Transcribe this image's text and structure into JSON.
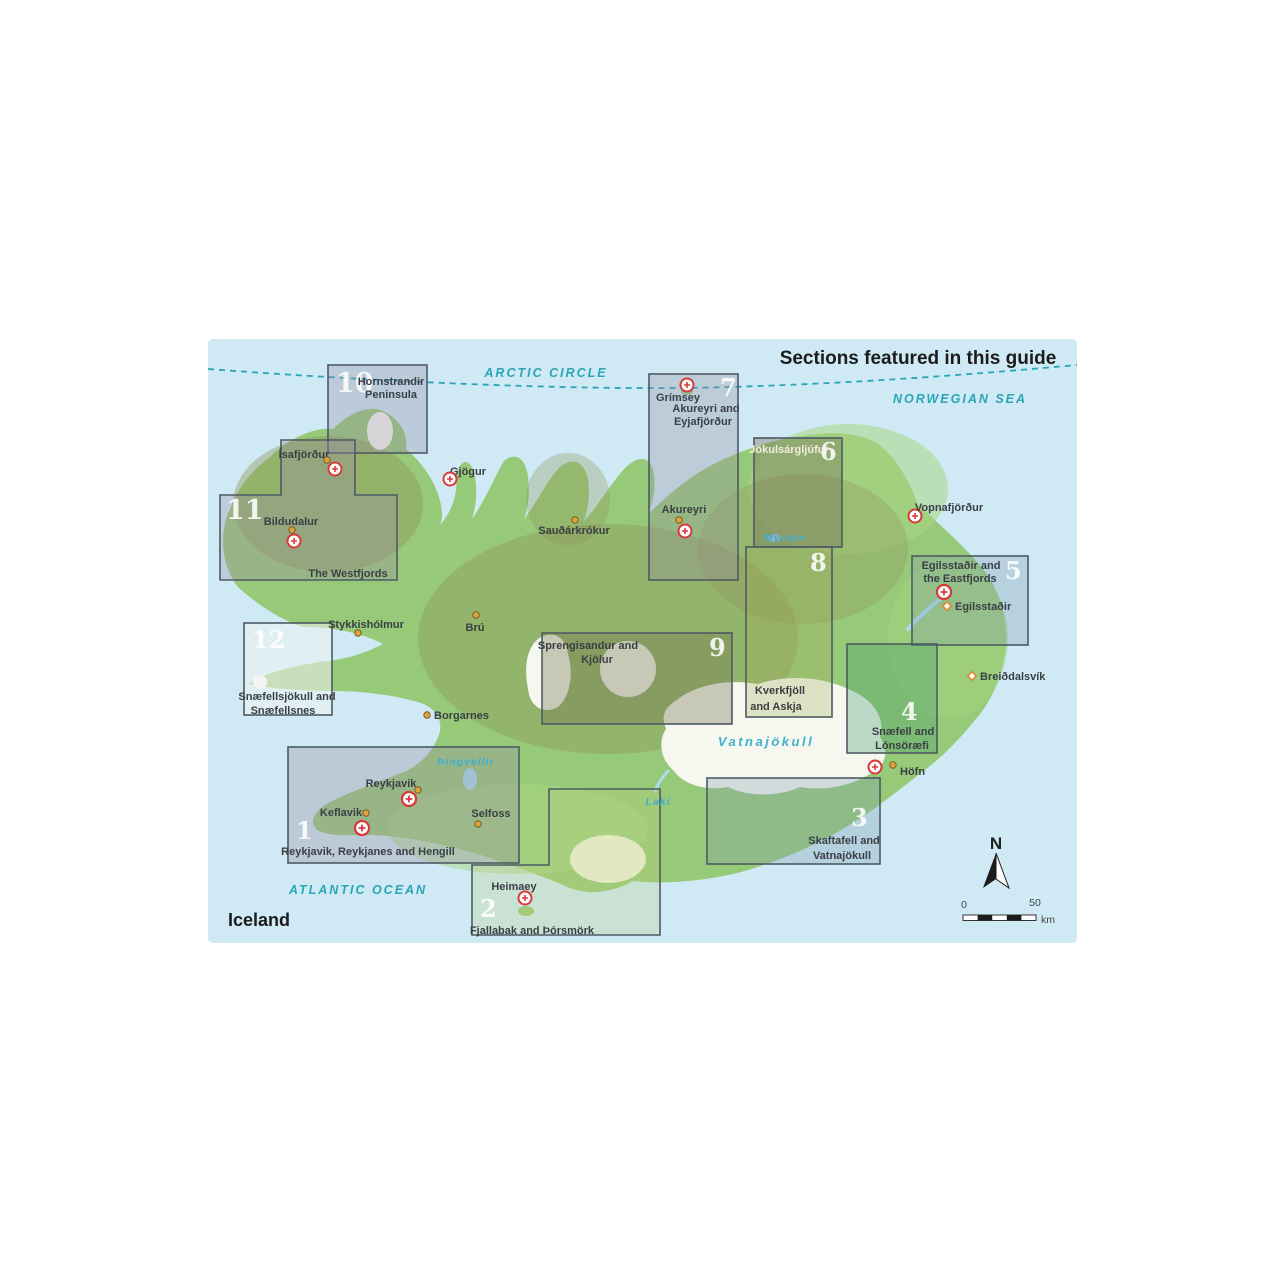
{
  "title": "Sections featured in this guide",
  "country_label": "Iceland",
  "sea_labels": {
    "arctic_circle": "ARCTIC CIRCLE",
    "norwegian_sea": "NORWEGIAN SEA",
    "atlantic_ocean": "ATLANTIC OCEAN"
  },
  "geo_labels": {
    "vatnajokull": "Vatnajökull",
    "myvatn": "Mývatn",
    "laki": "Laki",
    "thingvellir": "Þingvellir"
  },
  "sections": [
    {
      "number": "1",
      "lines": [
        "Reykjavik, Reykjanes and Hengill"
      ]
    },
    {
      "number": "2",
      "lines": [
        "Fjallabak and Þórsmörk"
      ]
    },
    {
      "number": "3",
      "lines": [
        "Skaftafell and",
        "Vatnajökull"
      ]
    },
    {
      "number": "4",
      "lines": [
        "Snæfell and",
        "Lónsöræfi"
      ]
    },
    {
      "number": "5",
      "lines": [
        "Egilsstaðir and",
        "the Eastfjords"
      ]
    },
    {
      "number": "6",
      "lines": [
        "Jökulsárgljúfur"
      ]
    },
    {
      "number": "7",
      "lines": [
        "Akureyri and",
        "Eyjafjörður"
      ]
    },
    {
      "number": "8",
      "lines": [
        "Kverkfjöll",
        "and Askja"
      ]
    },
    {
      "number": "9",
      "lines": [
        "Sprengisandur and",
        "Kjölur"
      ]
    },
    {
      "number": "10",
      "lines": [
        "Hornstrandir",
        "Peninsula"
      ]
    },
    {
      "number": "11",
      "lines": [
        "The Westfjords"
      ]
    },
    {
      "number": "12",
      "lines": [
        "Snæfellsjökull and",
        "Snæfellsnes"
      ]
    }
  ],
  "towns": {
    "isafjordur": {
      "name": "Ísafjörður"
    },
    "bildudalur": {
      "name": "Bildudalur"
    },
    "gjogur": {
      "name": "Gjögur"
    },
    "grimsey": {
      "name": "Grímsey"
    },
    "saudarkrokur": {
      "name": "Sauðárkrókur"
    },
    "akureyri": {
      "name": "Akureyri"
    },
    "vopnafjordur": {
      "name": "Vopnafjörður"
    },
    "egilsstadir": {
      "name": "Egilsstaðir"
    },
    "breiddalsvik": {
      "name": "Breiðdalsvík"
    },
    "hofn": {
      "name": "Höfn"
    },
    "stykkisholmur": {
      "name": "Stykkishólmur"
    },
    "bru": {
      "name": "Brú"
    },
    "borgarnes": {
      "name": "Borgarnes"
    },
    "reykjavik": {
      "name": "Reykjavik"
    },
    "keflavik": {
      "name": "Keflavik"
    },
    "selfoss": {
      "name": "Selfoss"
    },
    "heimaey": {
      "name": "Heimaey"
    }
  },
  "compass": {
    "north_label": "N"
  },
  "scale_bar": {
    "start": "0",
    "end": "50",
    "unit": "km"
  },
  "colors": {
    "sea": "#cfeaf4",
    "land": "#97ca78",
    "highland": "#8f9158",
    "glacier": "#f6f8ef",
    "teal_label": "#2aa5b8",
    "marker_red": "#d63a3a",
    "town_dot": "#dfa33c"
  }
}
